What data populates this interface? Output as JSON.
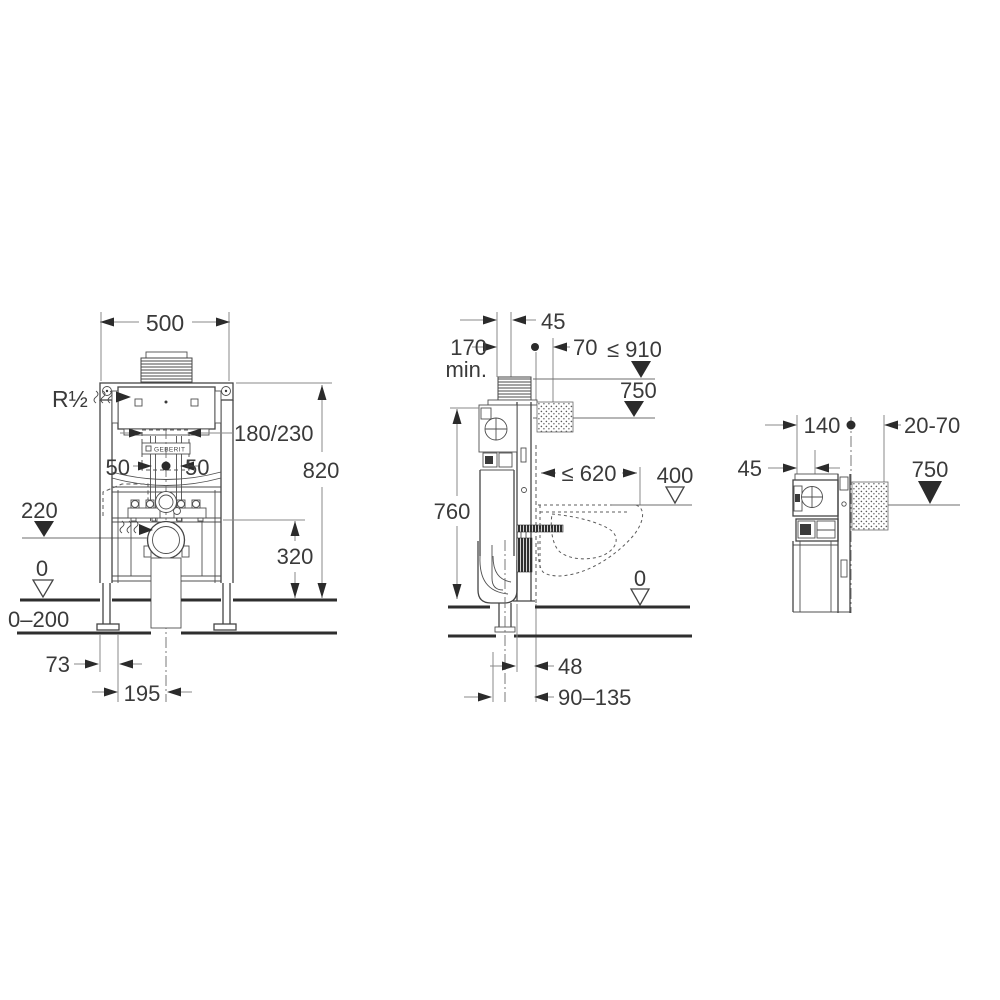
{
  "drawing": {
    "brand_logo": "GEBERIT",
    "colors": {
      "object_line": "#454545",
      "dimension_line": "#8a8a8a",
      "text": "#3a3a3a",
      "floor_line": "#2e2e2e",
      "background": "#ffffff"
    },
    "front_view": {
      "dim_width": "500",
      "water_connection": "R½",
      "pipe_spacing": "180/230",
      "offset_left": "50",
      "offset_right": "50",
      "dim_height": "820",
      "level_supply": "220",
      "dim_outlet_height": "320",
      "level_floor": "0",
      "range_floor": "0–200",
      "dim_leg_offset": "73",
      "dim_leg_span": "195"
    },
    "side_view": {
      "dim_plate_depth": "45",
      "dim_min_depth": "170",
      "dim_min_suffix": "min.",
      "dim_offset": "70",
      "level_max_height": "≤ 910",
      "level_actuator": "750",
      "dim_element_height": "760",
      "dim_bowl_depth": "≤ 620",
      "level_bowl_top": "400",
      "level_floor": "0",
      "dim_pipe_offset": "48",
      "dim_pipe_range": "90–135"
    },
    "detail_view": {
      "dim_depth": "140",
      "range_wall": "20-70",
      "dim_plate_depth": "45",
      "level_actuator": "750"
    }
  }
}
